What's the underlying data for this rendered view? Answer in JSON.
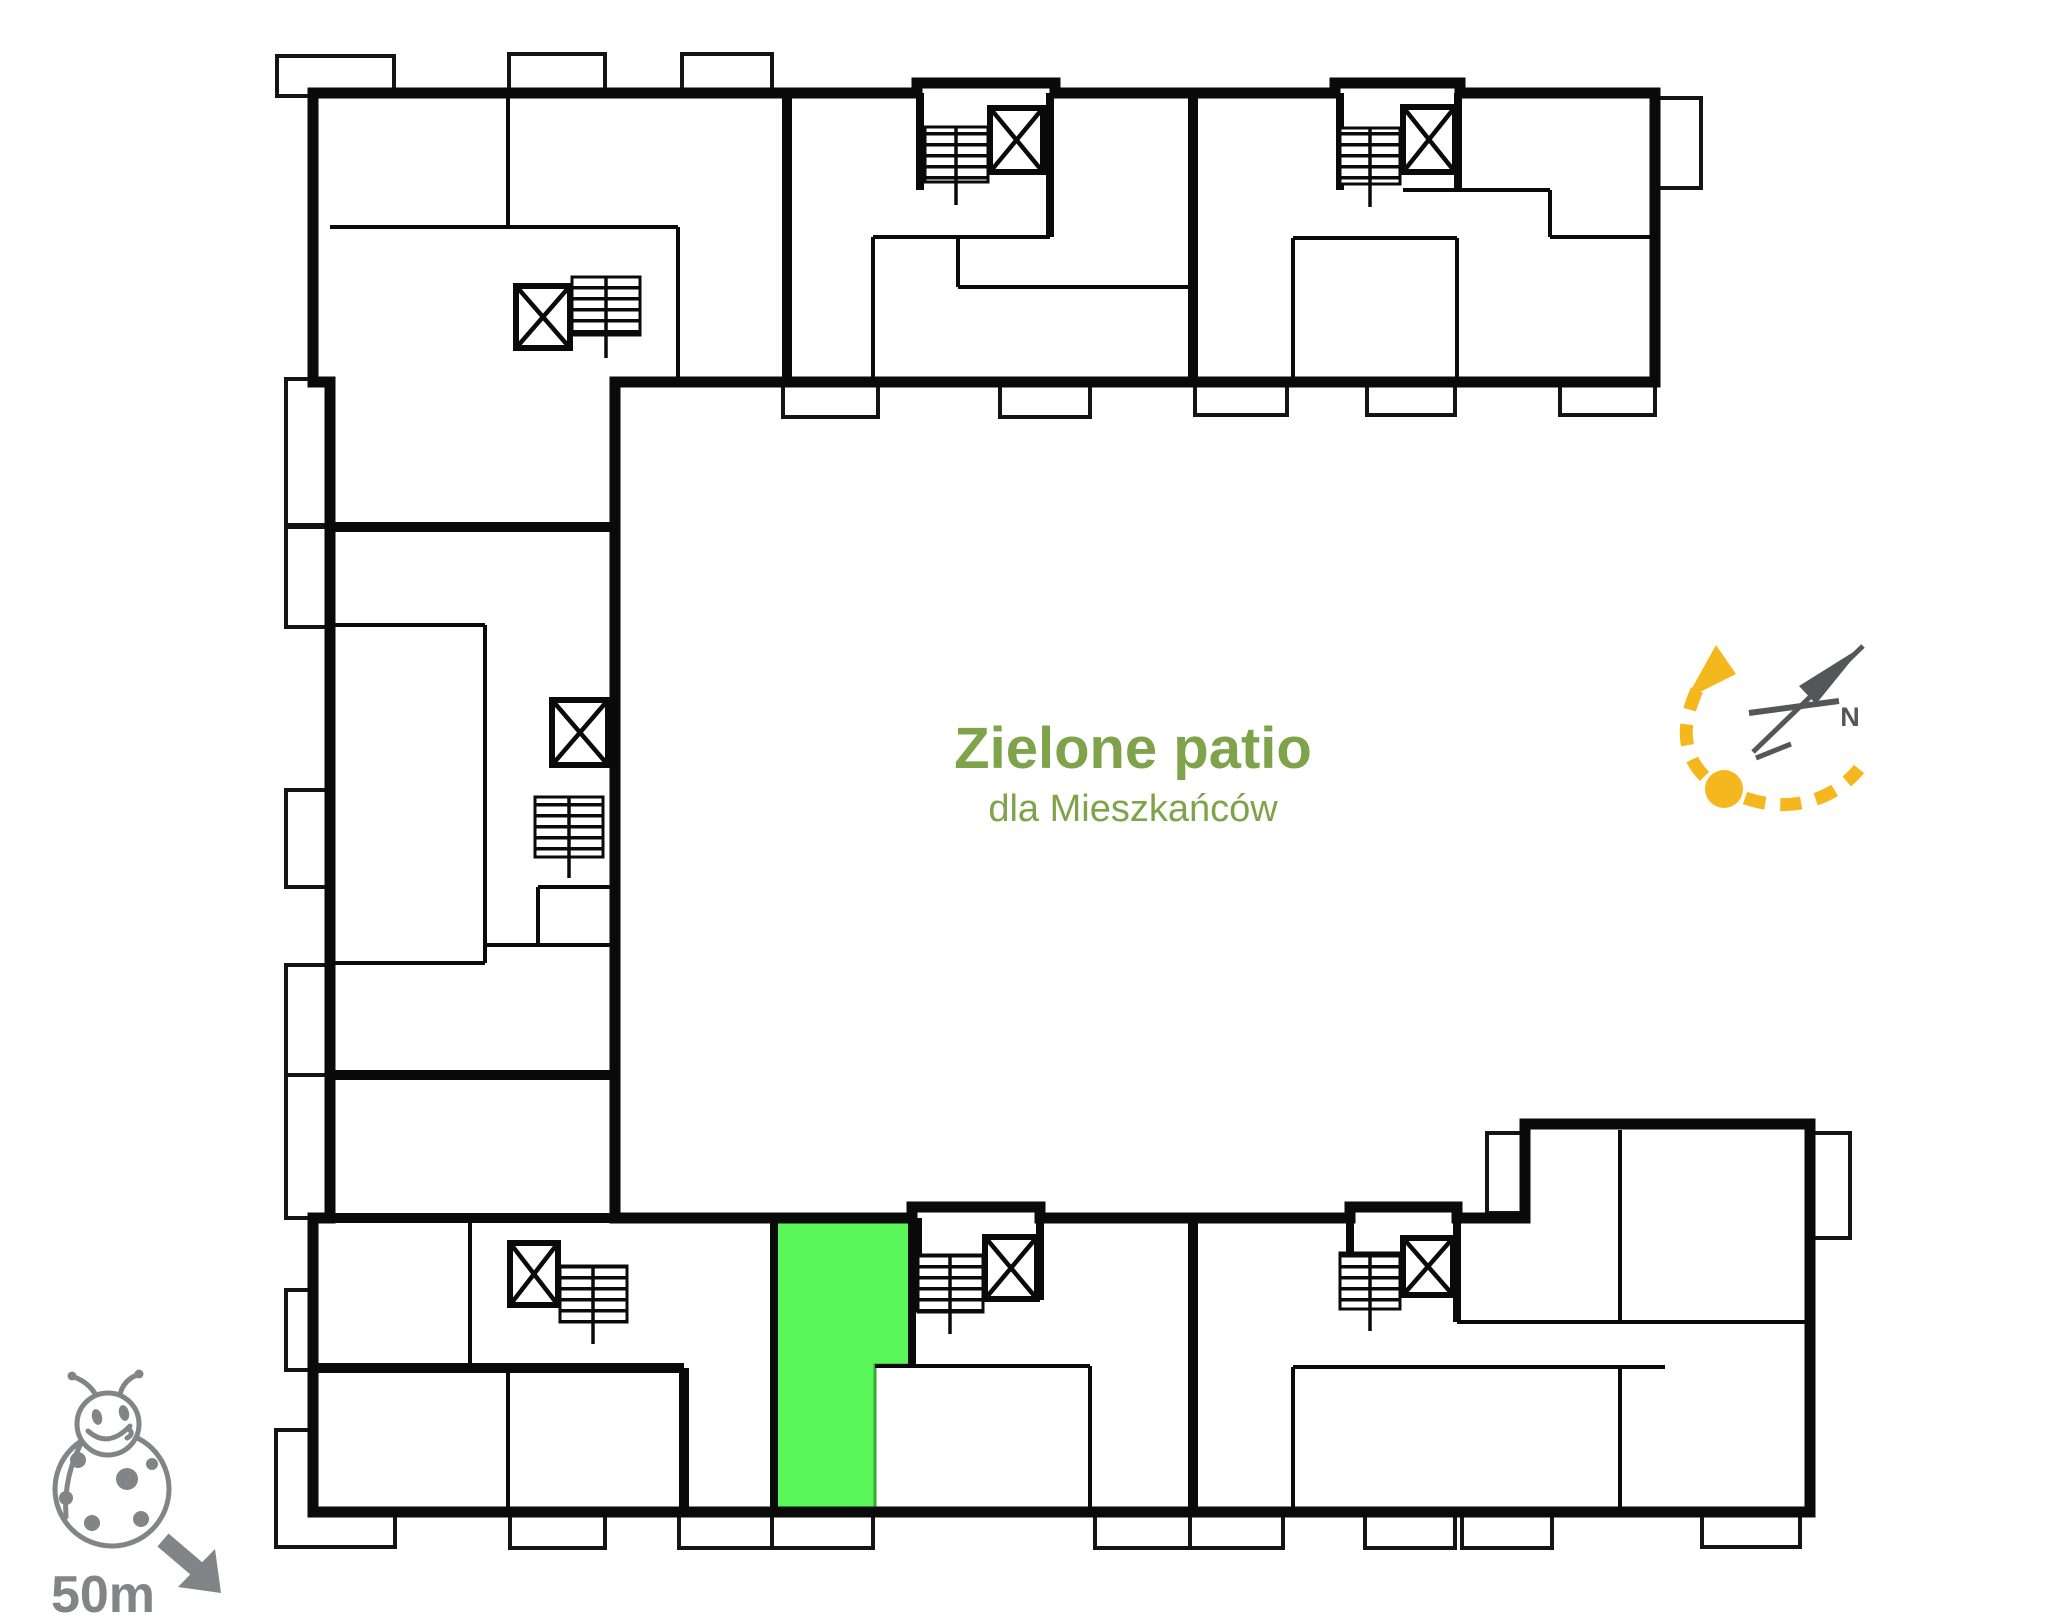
{
  "patio": {
    "title": "Zielone patio",
    "subtitle": "dla Mieszkańców"
  },
  "compass": {
    "north_label": "N"
  },
  "scale_indicator": {
    "label": "50m"
  },
  "icons": {
    "compass": "north-compass-icon",
    "logo": "ladybug-icon",
    "scale_arrow": "arrow-down-right-icon",
    "stairwell": "stairwell-symbol"
  },
  "colors": {
    "wall": "#0a0a0a",
    "highlight_green": "#59f659",
    "highlight_green_border": "#36a836",
    "patio_text": "#7ea34a",
    "compass_yellow": "#f4b71d",
    "compass_needle_gray": "#55565a",
    "logo_gray": "#828487",
    "background": "#ffffff"
  }
}
